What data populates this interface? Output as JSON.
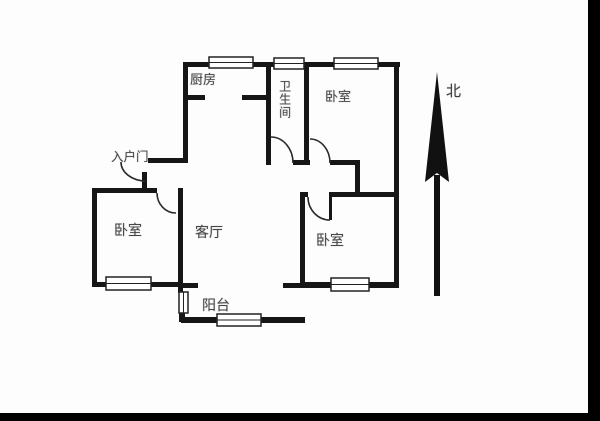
{
  "rooms": [
    {
      "id": "kitchen",
      "label": "厨房"
    },
    {
      "id": "bathroom",
      "label": "卫生间"
    },
    {
      "id": "bedroom-north",
      "label": "卧室"
    },
    {
      "id": "bedroom-west",
      "label": "卧室"
    },
    {
      "id": "living-room",
      "label": "客厅"
    },
    {
      "id": "bedroom-south",
      "label": "卧室"
    },
    {
      "id": "balcony",
      "label": "阳台"
    }
  ],
  "entrance": {
    "label": "入户门"
  },
  "compass": {
    "north_label": "北",
    "icon": "north-arrow-icon"
  },
  "colors": {
    "wall": "#161616",
    "door_arc": "#2a2a2a",
    "window_frame": "#222222",
    "text": "#474747",
    "background": "#fdfdfd",
    "frame_bar": "#000000"
  }
}
